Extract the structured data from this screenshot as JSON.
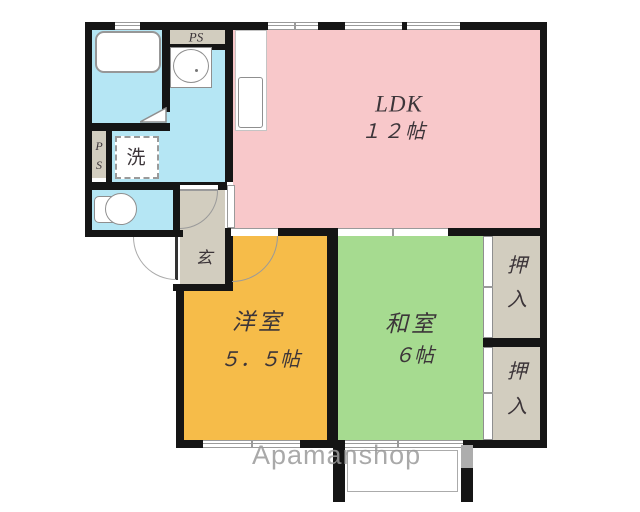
{
  "title": "2LDK apartment floor plan",
  "watermark": "Apamanshop",
  "rooms": {
    "ldk": {
      "name": "LDK",
      "size": "１２帖"
    },
    "western_room": {
      "name": "洋室",
      "size": "５．５帖"
    },
    "japanese_room": {
      "name": "和室",
      "size": "６帖"
    },
    "genkan": {
      "label": "玄"
    },
    "washer": {
      "label": "洗"
    },
    "pipe_space_top": {
      "label": "PS"
    },
    "pipe_space_left": {
      "line1": "P",
      "line2": "S"
    },
    "closet_upper": {
      "char1": "押",
      "char2": "入"
    },
    "closet_lower": {
      "char1": "押",
      "char2": "入"
    }
  },
  "colors": {
    "ldk_pink": "#f8c8ca",
    "western_orange": "#f6bc49",
    "japanese_green": "#a6db90",
    "wet_area_cyan": "#b5e6f4",
    "service_beige": "#d2cdbf",
    "wall_black": "#151515"
  }
}
